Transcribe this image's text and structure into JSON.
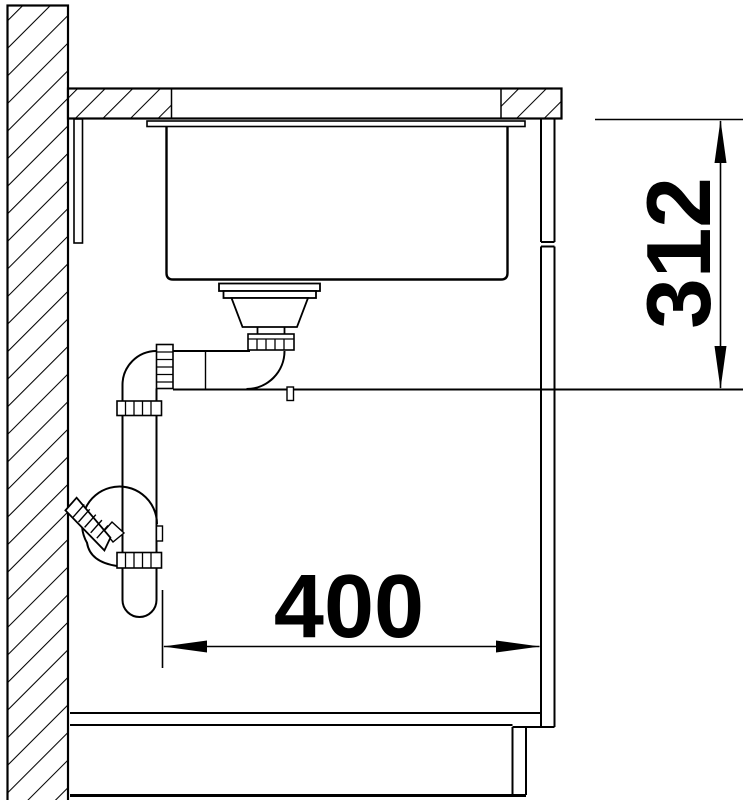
{
  "drawing": {
    "background": "#ffffff",
    "line_color": "#000000",
    "dimensions": {
      "vertical": {
        "label": "312"
      },
      "horizontal": {
        "label": "400"
      }
    }
  }
}
